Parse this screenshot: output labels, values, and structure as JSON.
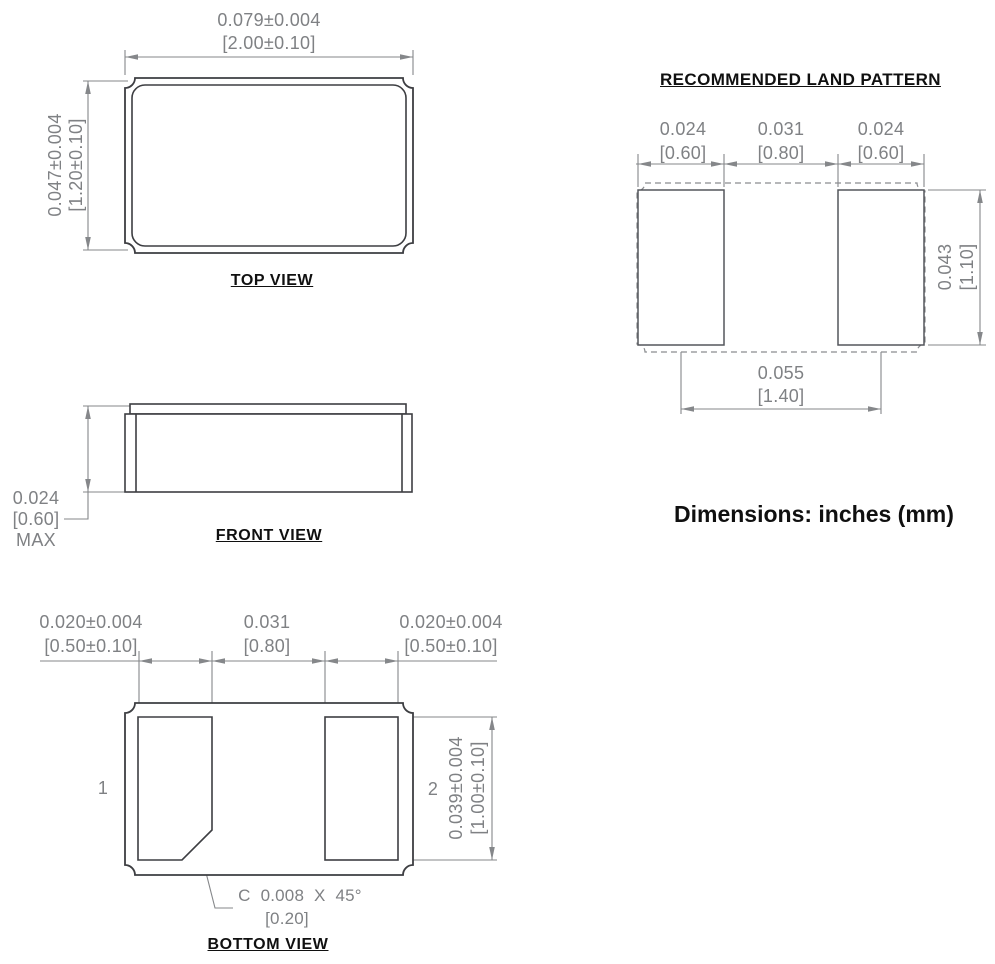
{
  "colors": {
    "line_dark": "#3d3e42",
    "line_dim": "#85878a",
    "text_dim": "#7f8184",
    "text_dark": "#101010"
  },
  "top_view": {
    "label": "TOP VIEW",
    "width_in": "0.079±0.004",
    "width_mm": "[2.00±0.10]",
    "height_in": "0.047±0.004",
    "height_mm": "[1.20±0.10]"
  },
  "front_view": {
    "label": "FRONT VIEW",
    "height_in": "0.024",
    "height_mm": "[0.60]",
    "height_qual": "MAX"
  },
  "bottom_view": {
    "label": "BOTTOM VIEW",
    "pin1": "1",
    "pin2": "2",
    "pad1_w_in": "0.020±0.004",
    "pad1_w_mm": "[0.50±0.10]",
    "gap_in": "0.031",
    "gap_mm": "[0.80]",
    "pad2_w_in": "0.020±0.004",
    "pad2_w_mm": "[0.50±0.10]",
    "pad_h_in": "0.039±0.004",
    "pad_h_mm": "[1.00±0.10]",
    "chamfer_in": "C 0.008 X 45°",
    "chamfer_mm": "[0.20]"
  },
  "land_pattern": {
    "title": "RECOMMENDED LAND PATTERN",
    "pad1_w_in": "0.024",
    "pad1_w_mm": "[0.60]",
    "gap_in": "0.031",
    "gap_mm": "[0.80]",
    "pad2_w_in": "0.024",
    "pad2_w_mm": "[0.60]",
    "pad_h_in": "0.043",
    "pad_h_mm": "[1.10]",
    "pitch_in": "0.055",
    "pitch_mm": "[1.40]"
  },
  "note": "Dimensions: inches (mm)"
}
